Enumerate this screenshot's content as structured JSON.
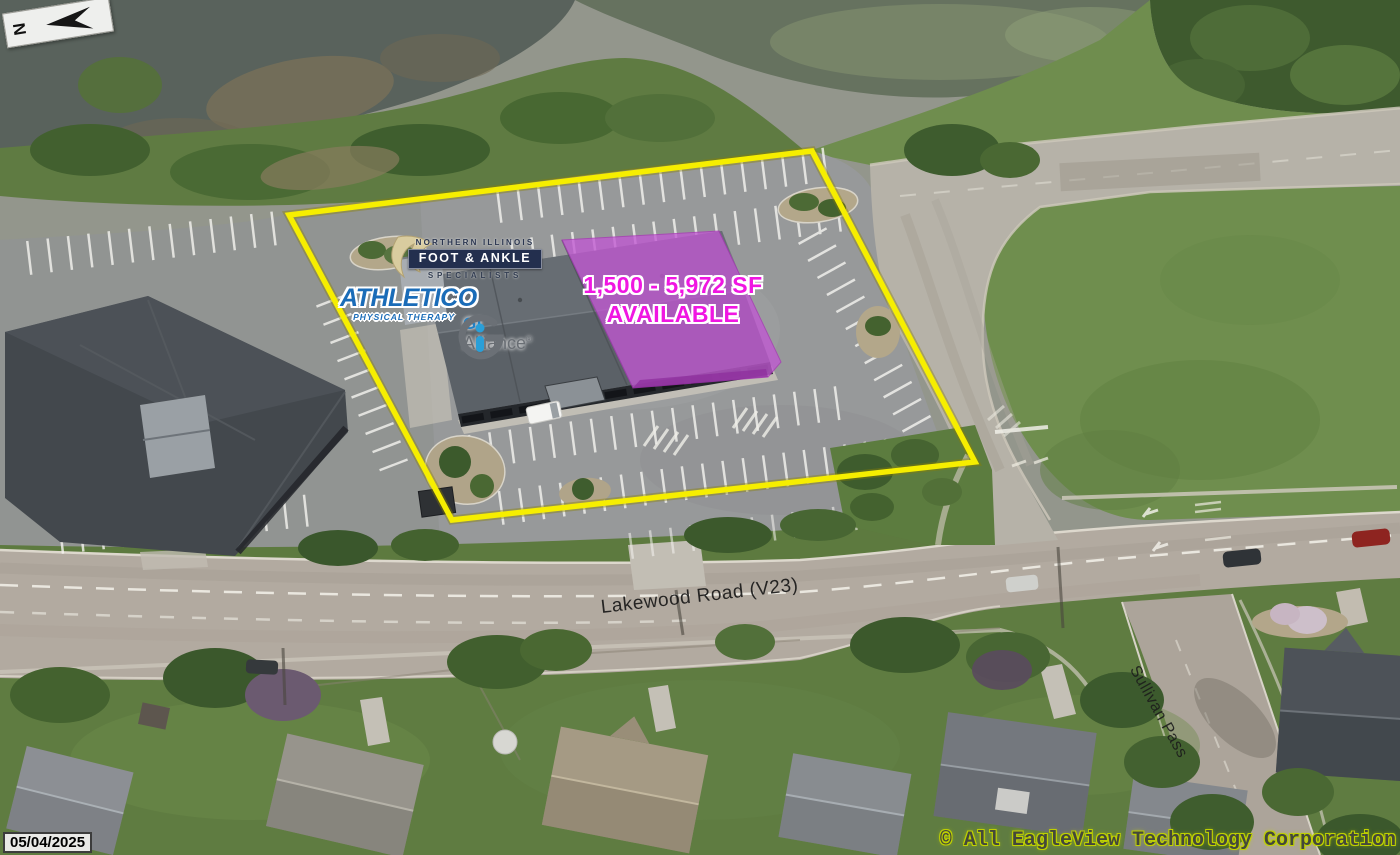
{
  "meta": {
    "date_stamp": "05/04/2025",
    "copyright": "© All EagleView Technology Corporation",
    "north_label": "N"
  },
  "annotations": {
    "availability_line1": "1,500 - 5,972 SF",
    "availability_line2": "AVAILABLE",
    "availability_text_color": "#f016e2",
    "boundary_color": "#f6ee00",
    "highlight_fill": "#c158d2"
  },
  "tenants": {
    "foot_ankle_top": "NORTHERN ILLINOIS",
    "foot_ankle_name": "FOOT & ANKLE",
    "foot_ankle_bottom": "SPECIALISTS",
    "athletico_name": "ATHLETICO",
    "athletico_sub": "PHYSICAL THERAPY",
    "gi_alliance_name": "GI",
    "gi_alliance_sub": "Alliance",
    "gi_alliance_reg": "®"
  },
  "roads": {
    "lakewood": "Lakewood Road (V23)",
    "sullivan": "Sullivan Pass"
  }
}
